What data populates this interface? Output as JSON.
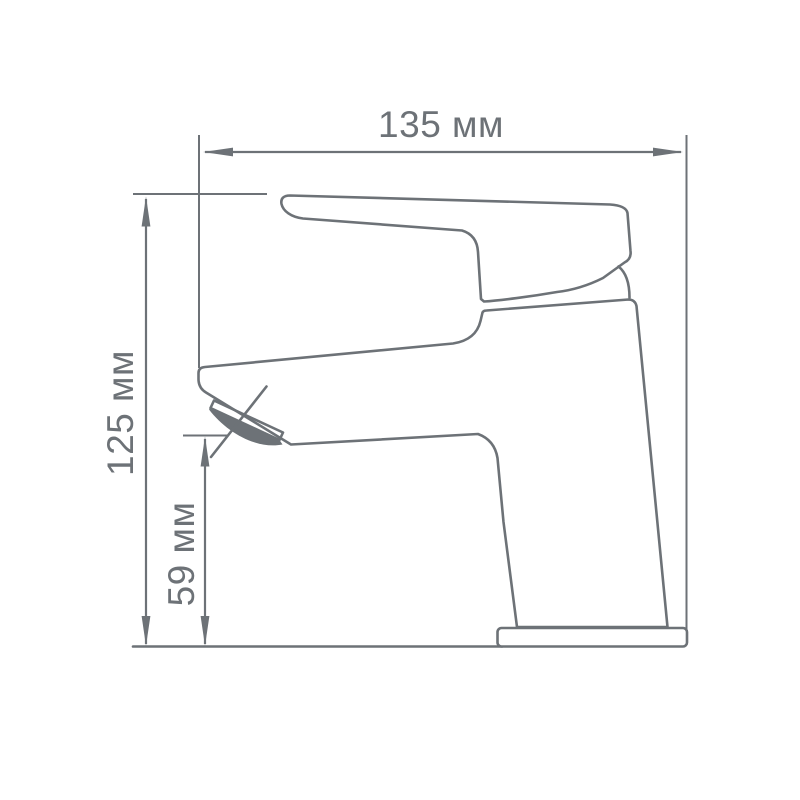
{
  "diagram": {
    "type": "technical-drawing",
    "subject": "single-lever-basin-faucet-side-view",
    "dimensions": {
      "width": {
        "label": "135 мм",
        "value": 135,
        "unit": "мм"
      },
      "height": {
        "label": "125 мм",
        "value": 125,
        "unit": "мм"
      },
      "spout_height": {
        "label": "59 мм",
        "value": 59,
        "unit": "мм"
      }
    },
    "colors": {
      "line": "#6d7277",
      "background": "#ffffff"
    }
  }
}
